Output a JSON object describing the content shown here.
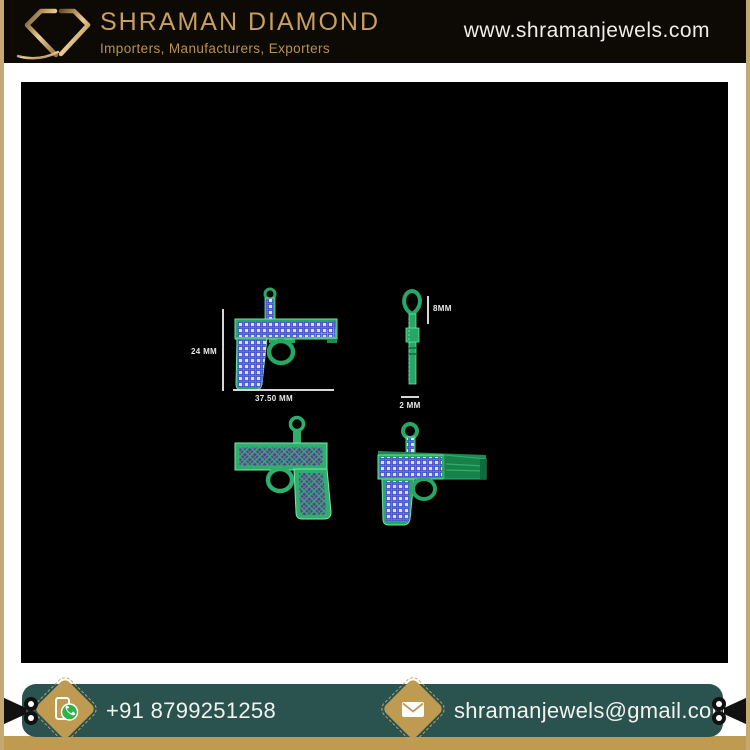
{
  "header": {
    "brand_name": "SHRAMAN DIAMOND",
    "tagline": "Importers, Manufacturers, Exporters",
    "website": "www.shramanjewels.com"
  },
  "annotations": {
    "pendant_height": "24 MM",
    "pendant_width": "37.50 MM",
    "bail_height": "8MM",
    "pendant_thickness": "2 MM"
  },
  "footer": {
    "phone": "+91 8799251258",
    "email": "shramanjewels@gmail.com"
  },
  "icons": {
    "logo": "diamond-logo-icon",
    "phone": "whatsapp-phone-icon",
    "email": "envelope-icon",
    "edge_left": "film-camera-icon",
    "edge_right": "film-camera-icon"
  },
  "colors": {
    "header_bg": "#0D0905",
    "brand_gold": "#C89F5E",
    "frame_tan": "#C6A972",
    "canvas_bg": "#000000",
    "footer_teal": "#2A5350",
    "footer_gold_strip": "#BF9B52",
    "render_green": "#26A765",
    "render_purple": "#6C2FA0",
    "stud_lavender": "#DFE1FC",
    "dimension_text": "#E8E8E8"
  }
}
